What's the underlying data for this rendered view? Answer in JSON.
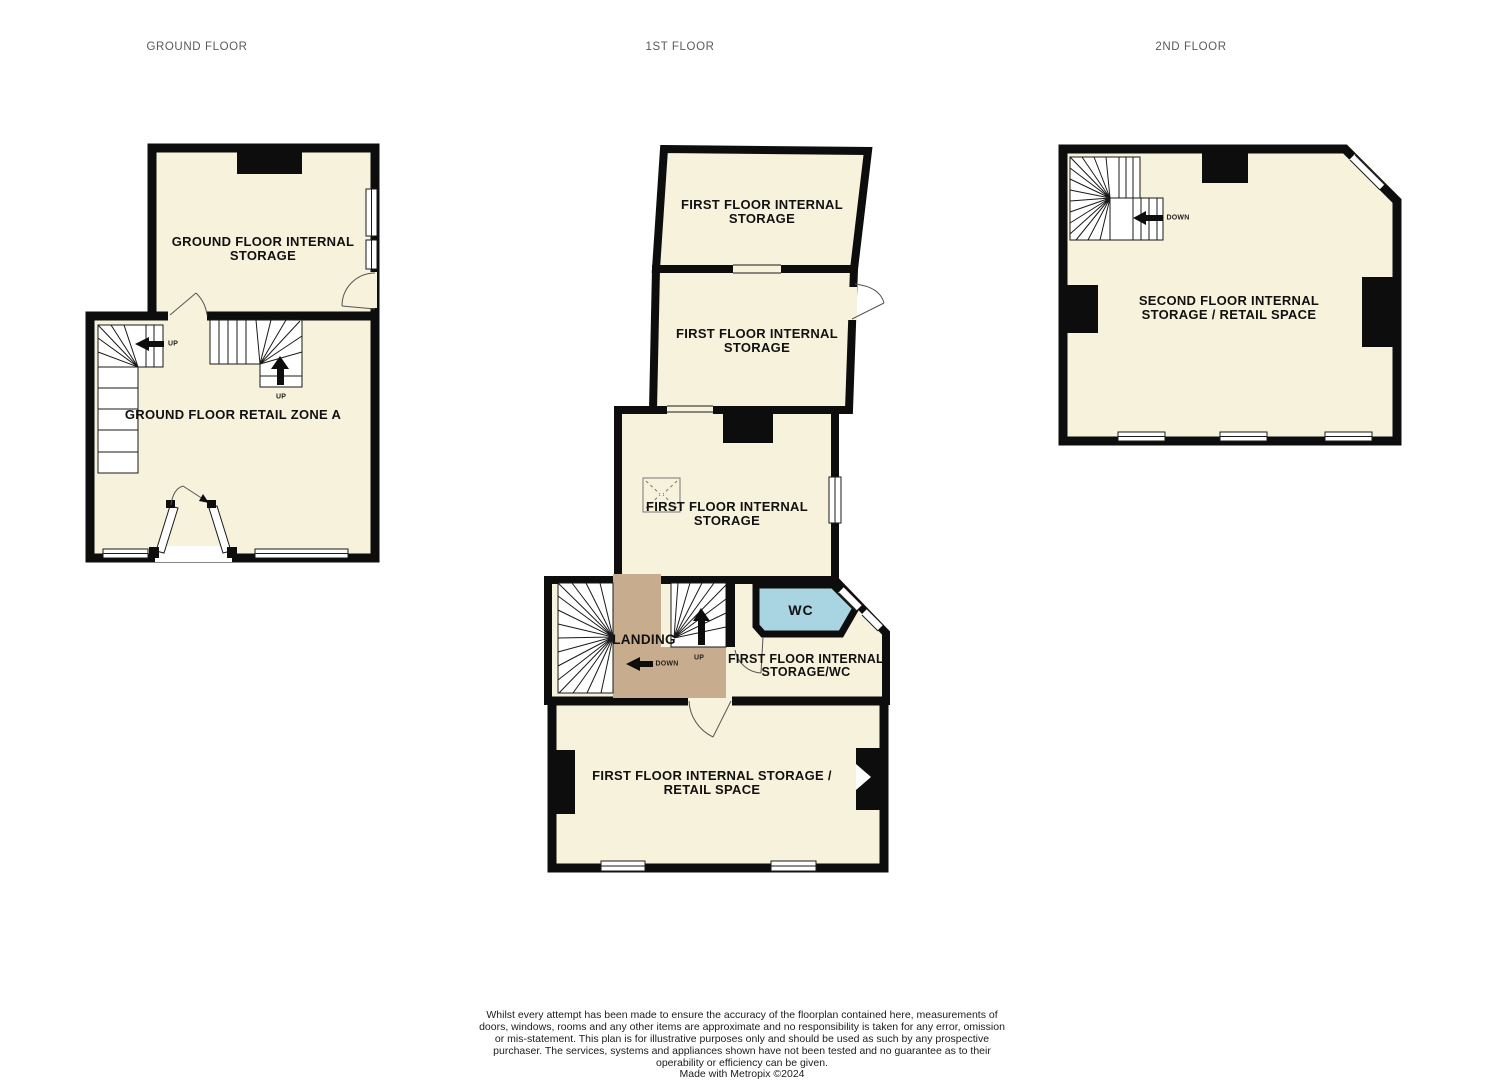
{
  "colors": {
    "floor_fill": "#F7F2DC",
    "wall": "#0D0D0D",
    "landing_fill": "#C7AD8E",
    "wc_fill": "#A9D4E1",
    "stair_line": "#1A1A1A",
    "title_gray": "#5A5A5A"
  },
  "floors": {
    "ground": {
      "title": "GROUND FLOOR",
      "rooms": {
        "storage": "GROUND FLOOR INTERNAL STORAGE",
        "retail": "GROUND FLOOR RETAIL ZONE A"
      },
      "labels": {
        "stair_left": "UP",
        "stair_mid": "UP"
      }
    },
    "first": {
      "title": "1ST FLOOR",
      "rooms": {
        "storage_top": "FIRST FLOOR INTERNAL STORAGE",
        "storage_mid": "FIRST FLOOR INTERNAL STORAGE",
        "storage_main": "FIRST FLOOR INTERNAL STORAGE",
        "wc": "WC",
        "landing": "LANDING",
        "storage_wc": "FIRST FLOOR INTERNAL STORAGE/WC",
        "retail": "FIRST FLOOR INTERNAL STORAGE / RETAIL SPACE"
      },
      "labels": {
        "stair_down": "DOWN",
        "stair_up": "UP"
      }
    },
    "second": {
      "title": "2ND FLOOR",
      "rooms": {
        "main": "SECOND FLOOR INTERNAL STORAGE / RETAIL SPACE"
      },
      "labels": {
        "stair_down": "DOWN"
      }
    }
  },
  "footer": {
    "disclaimer_lines": [
      "Whilst every attempt has been made to ensure the accuracy of the floorplan contained here, measurements of doors, windows, rooms and any other items are approximate and no responsibility is taken for any error, omission or mis-statement. This plan is for illustrative purposes only and should be used as such by any prospective purchaser. The services, systems and appliances shown have not been tested and no guarantee as to their operability or efficiency can be given."
    ],
    "credit": "Made with Metropix ©2024"
  }
}
